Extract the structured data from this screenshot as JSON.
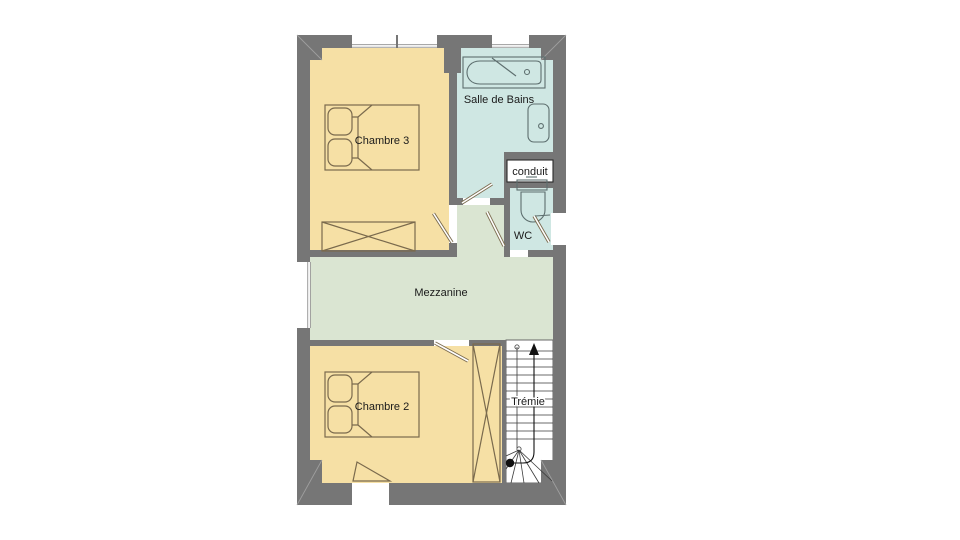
{
  "page_title": "Floor plan - étage",
  "colors": {
    "wall": "#767676",
    "wall_miter": "#9e9e9e",
    "bedroom": "#f6e0a5",
    "bath": "#cfe7e3",
    "mezzanine": "#dae5d2",
    "stairs": "#ffffff",
    "furniture_line": "#7a6a4d",
    "fixture_line": "#5d6e6e",
    "stair_line": "#3a3a3a",
    "text": "#1a1a1a"
  },
  "rooms": {
    "chambre3": {
      "label": "Chambre 3"
    },
    "salle_de_bains": {
      "label": "Salle de Bains"
    },
    "conduit": {
      "label": "conduit"
    },
    "wc": {
      "label": "WC"
    },
    "mezzanine": {
      "label": "Mezzanine"
    },
    "chambre2": {
      "label": "Chambre 2"
    },
    "tremie": {
      "label": "Trémie"
    }
  },
  "fixtures": [
    "double-bed",
    "double-bed",
    "wardrobe",
    "wardrobe-tall",
    "bathtub",
    "washbasin",
    "toilet",
    "staircase"
  ]
}
